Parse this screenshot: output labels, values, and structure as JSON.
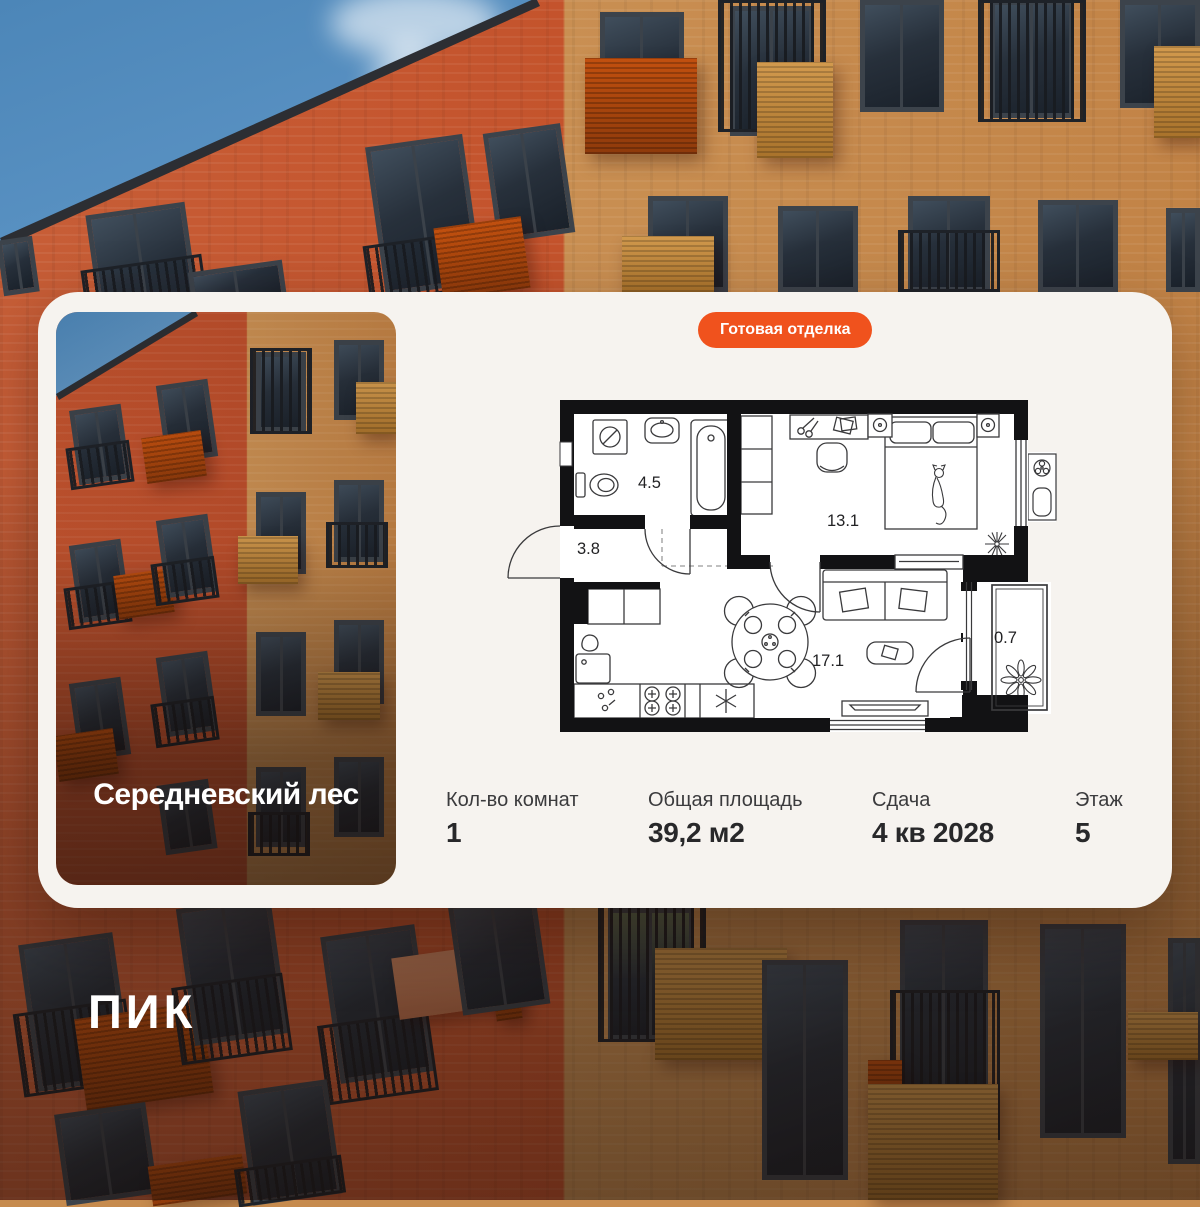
{
  "badge": {
    "label": "Готовая отделка"
  },
  "project": {
    "name": "Середневский лес"
  },
  "logo": {
    "text": "ПИК"
  },
  "floorplan": {
    "rooms": [
      {
        "id": "bathroom",
        "area": "4.5"
      },
      {
        "id": "hallway",
        "area": "3.8"
      },
      {
        "id": "bedroom",
        "area": "13.1"
      },
      {
        "id": "living-kitchen",
        "area": "17.1"
      },
      {
        "id": "balcony",
        "area": "0.7"
      }
    ]
  },
  "stats": {
    "items": [
      {
        "label": "Кол-во комнат",
        "value": "1"
      },
      {
        "label": "Общая площадь",
        "value": "39,2 м2"
      },
      {
        "label": "Сдача",
        "value": "4 кв 2028"
      },
      {
        "label": "Этаж",
        "value": "5"
      }
    ]
  },
  "colors": {
    "accent": "#F0521D",
    "card_bg": "#F6F3EF",
    "value_text": "#28282A",
    "label_text": "#3B3B3D",
    "sky": "#4C86B8",
    "brick_left": "#C4532C",
    "brick_right": "#C98F52"
  }
}
